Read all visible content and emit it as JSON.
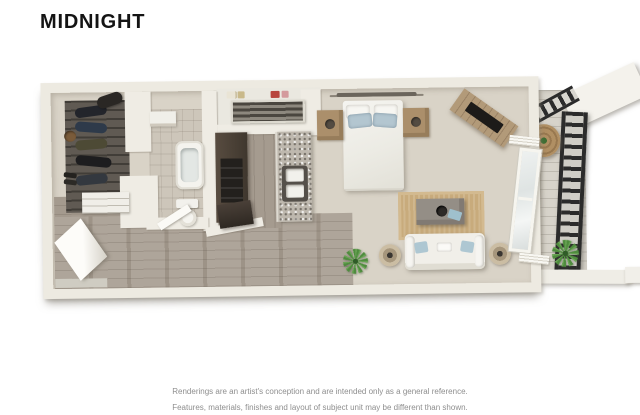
{
  "title": "MIDNIGHT",
  "disclaimer": {
    "line1": "Renderings are an artist's conception and are intended only as a general reference.",
    "line2": "Features, materials, finishes and layout of subject unit may be different than shown."
  },
  "floorplan": {
    "kind": "3d-top-down-floor-plan-rendering",
    "unit_name": "Midnight",
    "rooms": [
      "walk-in-closet",
      "bathroom",
      "laundry-storage-closet",
      "galley-kitchen",
      "open-bedroom-living-area",
      "entry-hallway",
      "balcony"
    ],
    "furnishings": [
      "hanging-clothes",
      "duffel-bag",
      "hat",
      "shoes",
      "dresser",
      "bathtub",
      "toilet",
      "vanity",
      "slatted-storage-shelves",
      "shelf-items",
      "dark-cabinet-run",
      "range",
      "granite-counter",
      "double-basin-sink",
      "wall-shelf-above-bed",
      "bed-with-pillows",
      "nightstand-left",
      "nightstand-right",
      "angled-tv-console-with-tv",
      "jute-area-rug",
      "coffee-table-with-bowl-and-tray",
      "white-sofa-with-blue-pillows",
      "drum-floor-lamp-left",
      "drum-floor-lamp-right",
      "potted-plant",
      "sliding-glass-door",
      "open-entry-door",
      "balcony-round-table-with-plant",
      "balcony-potted-plant",
      "black-metal-railing"
    ],
    "palette": {
      "background": "#ffffff",
      "wall": "#edeae1",
      "wood_floor": "#a89e92",
      "closet_floor": "#57514a",
      "carpet": "#d9d3c7",
      "bath_tile": "#cdc6ba",
      "rug": "#c8ab7c",
      "cabinet_dark": "#453c33",
      "granite": "#beb8ae",
      "upholstery_white": "#f1efe9",
      "pillow_accent_blue": "#aec7d2",
      "wood_accent": "#ab8f6b",
      "plant_green": "#4f8c3e",
      "railing_black": "#2b2b2b",
      "title_text": "#141414",
      "disclaimer_text": "#8e8e8e"
    }
  }
}
